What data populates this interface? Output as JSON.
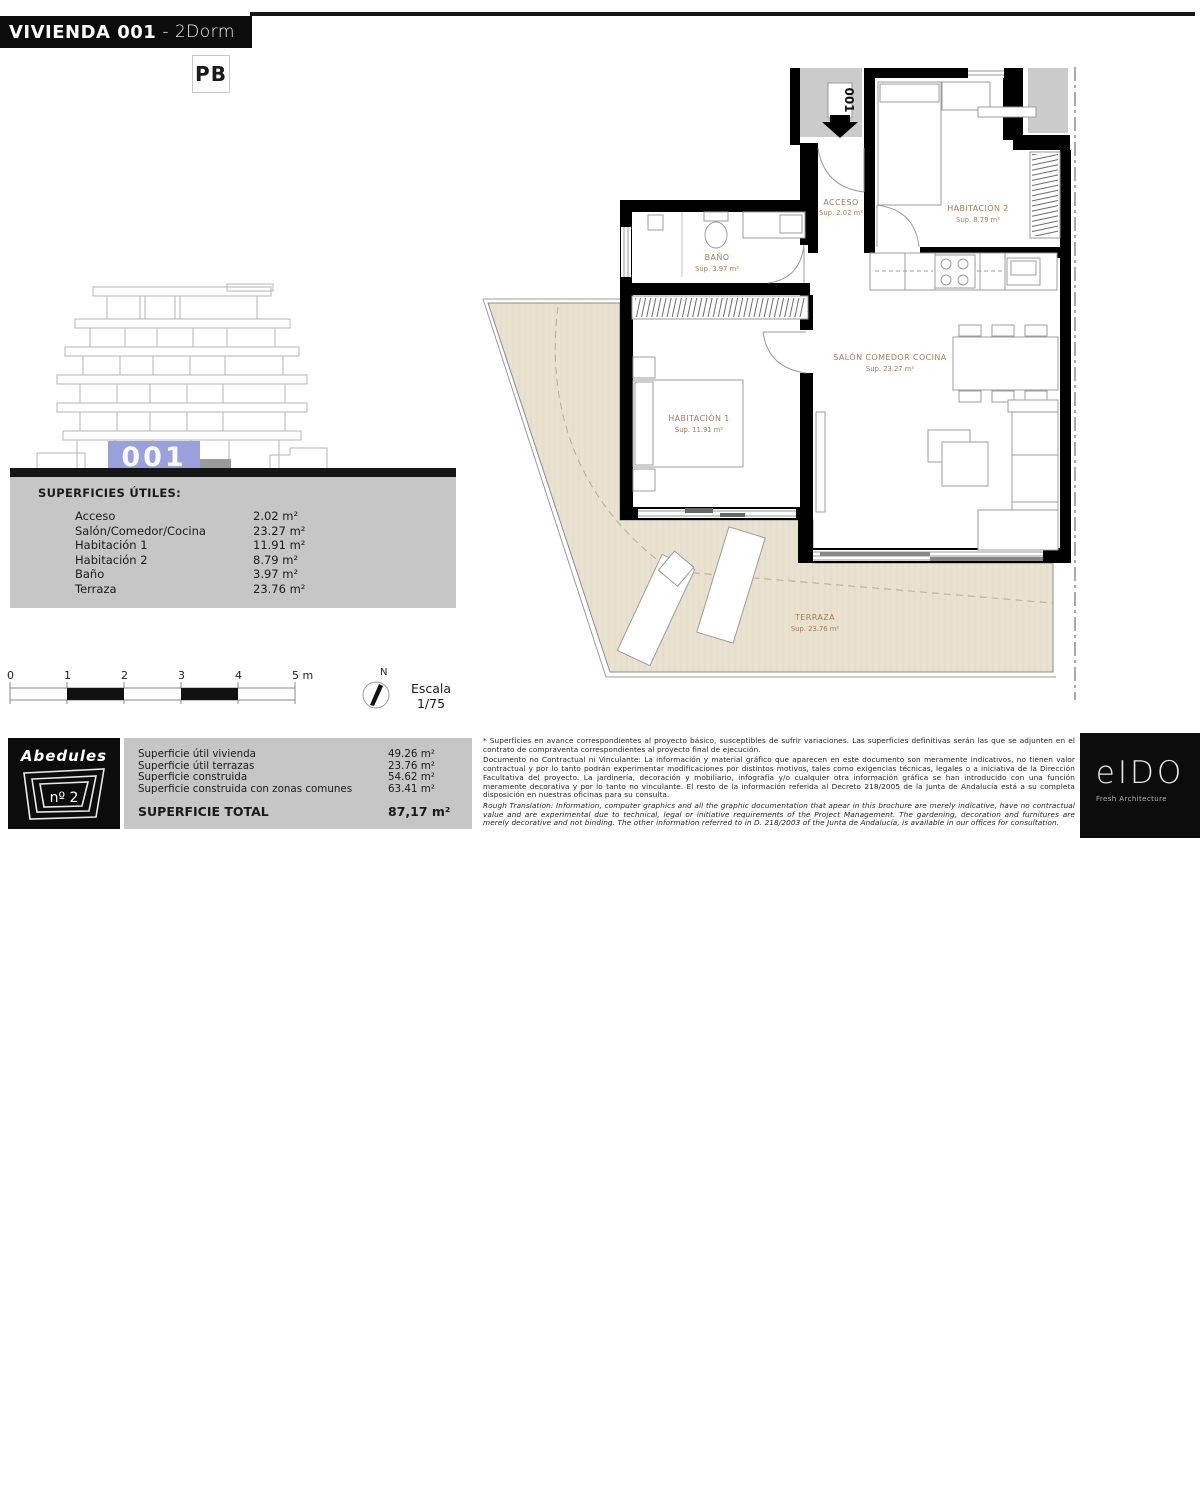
{
  "header": {
    "title_bold": "VIVIENDA 001",
    "title_light": "- 2Dorm",
    "floor_label": "PB"
  },
  "elevation": {
    "unit_number": "001",
    "highlight_color": "#99a0dc"
  },
  "surfaces_table": {
    "heading": "SUPERFICIES ÚTILES:",
    "rows": [
      {
        "label": "Acceso",
        "value": "2.02 m²"
      },
      {
        "label": "Salón/Comedor/Cocina",
        "value": "23.27 m²"
      },
      {
        "label": "Habitación 1",
        "value": "11.91 m²"
      },
      {
        "label": "Habitación 2",
        "value": "8.79 m²"
      },
      {
        "label": "Baño",
        "value": "3.97 m²"
      },
      {
        "label": "Terraza",
        "value": "23.76 m²"
      }
    ]
  },
  "scale_bar": {
    "ticks": [
      "0",
      "1",
      "2",
      "3",
      "4"
    ],
    "end_label": "5 m",
    "north_label": "N",
    "scale_word": "Escala",
    "scale_value": "1/75"
  },
  "project_logo": {
    "name": "Abedules",
    "number": "nº 2"
  },
  "summary_table": {
    "rows": [
      {
        "label": "Superficie útil vivienda",
        "value": "49.26 m²"
      },
      {
        "label": "Superficie útil terrazas",
        "value": "23.76 m²"
      },
      {
        "label": "Superficie construida",
        "value": "54.62 m²"
      },
      {
        "label": "Superficie construida con zonas comunes",
        "value": "63.41 m²"
      }
    ],
    "total_label": "SUPERFICIE TOTAL",
    "total_value": "87,17 m²"
  },
  "disclaimer": {
    "paragraphs": [
      "* Superficies en avance correspondientes al proyecto básico, susceptibles de sufrir variaciones. Las superficies definitivas serán las que se adjunten en el contrato de compraventa correspondientes al proyecto final de ejecución.",
      "Documento no Contractual ni Vinculante: La información y material gráfico que aparecen en este documento son meramente indicativos, no tienen valor contractual y por lo tanto podrán experimentar modificaciones por distintos motivos, tales como exigencias técnicas, legales o a iniciativa de la Dirección Facultativa del proyecto. La jardinería, decoración y mobiliario, infografía y/o cualquier otra información gráfica se han introducido con una función meramente decorativa y por lo tanto no vinculante. El resto de la información referida al Decreto 218/2005 de la Junta de Andalucía está a su completa disposición en nuestras oficinas para su consulta.",
      "Rough Translation: Information, computer graphics and all the graphic documentation that apear in this brochure are merely indicative, have no contractual value and are experimental due to technical, legal or initiative requirements of the Project Management. The gardening, decoration and furnitures are merely decorative and not binding. The other information referred to in D. 218/2003 of the Junta de Andalucía, is available in our offices for consultation."
    ]
  },
  "architect_logo": {
    "name": "eIDO",
    "tagline": "Fresh Architecture"
  },
  "plan": {
    "entry_marker": "001",
    "rooms": [
      {
        "name": "ACCESO",
        "sup": "Sup. 2.02 m²"
      },
      {
        "name": "HABITACIÓN 2",
        "sup": "Sup. 8.79 m²"
      },
      {
        "name": "BAÑO",
        "sup": "Sup. 3.97 m²"
      },
      {
        "name": "HABITACIÓN 1",
        "sup": "Sup. 11.91 m²"
      },
      {
        "name": "SALÓN COMEDOR COCINA",
        "sup": "Sup. 23.27 m²"
      },
      {
        "name": "TERRAZA",
        "sup": "Sup. 23.76 m²"
      }
    ],
    "colors": {
      "terrace_fill": "#eae2d1",
      "label": "#a87c54",
      "wall": "#000000"
    }
  }
}
